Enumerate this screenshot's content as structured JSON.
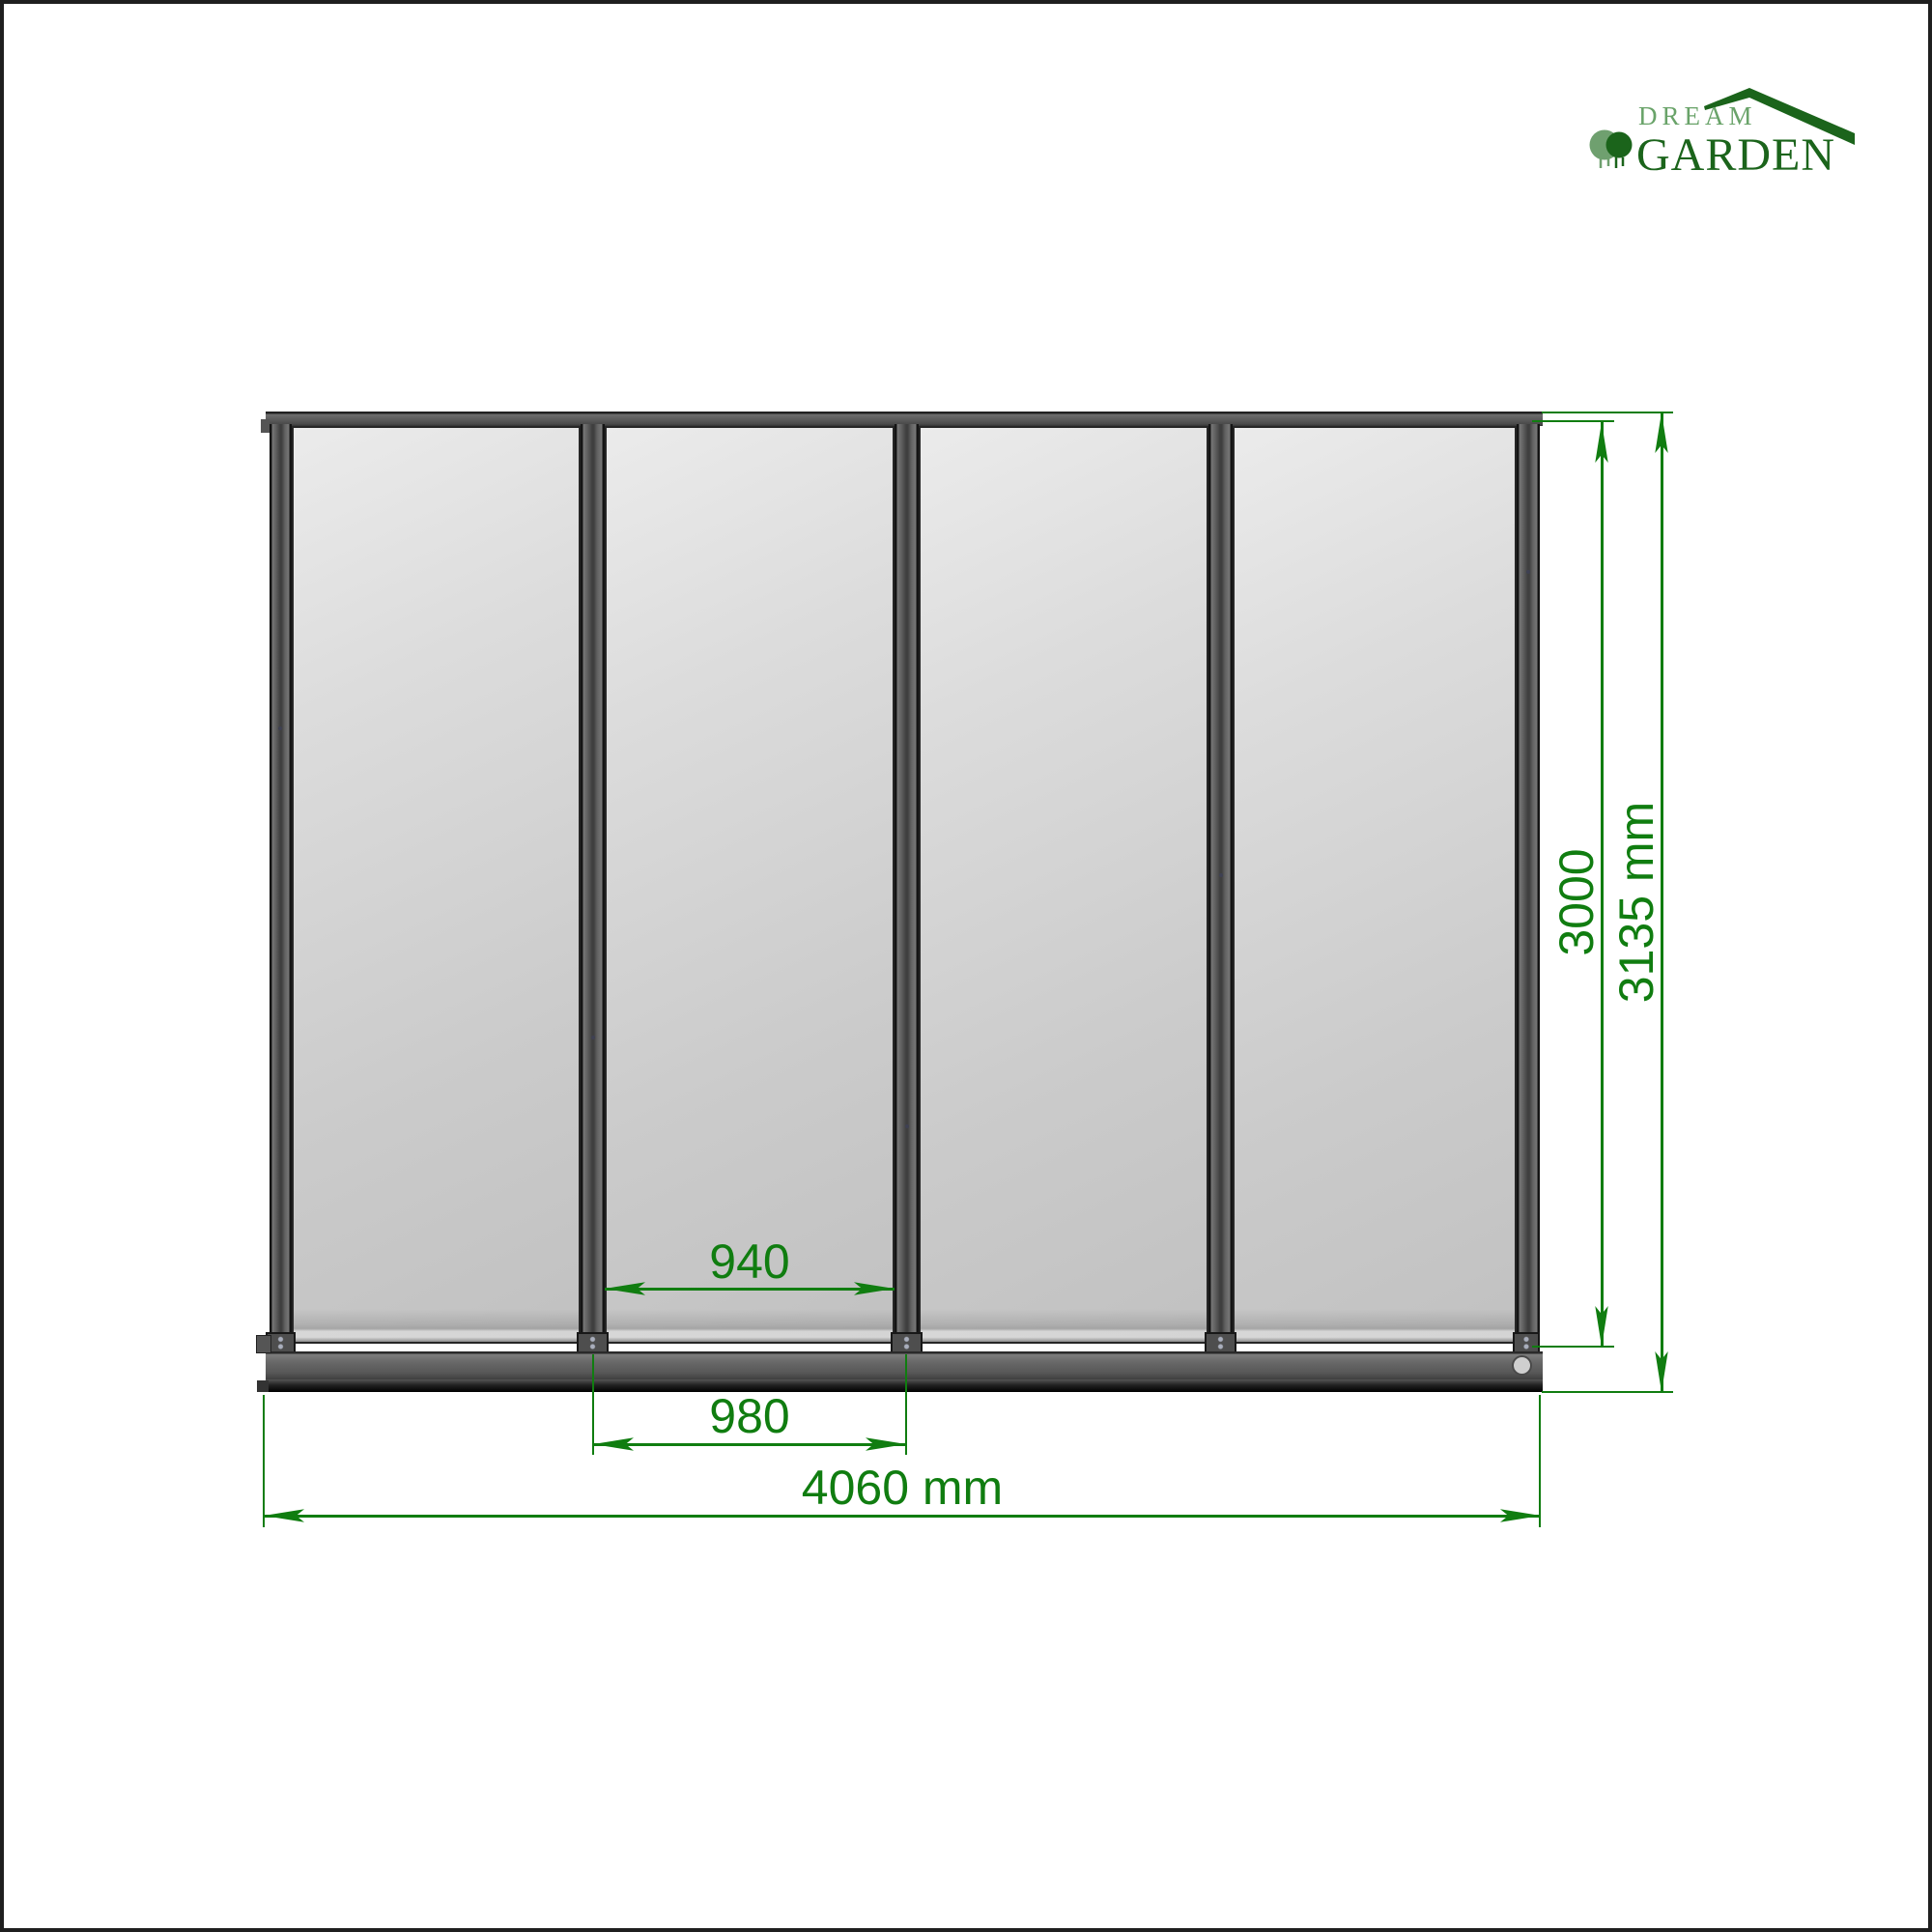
{
  "brand": {
    "word_top": "DREAM",
    "word_bottom": "GARDEN",
    "icons": [
      "tree-icon",
      "roof-icon"
    ],
    "color_light_green": "#69A369",
    "color_dark_green": "#1B641B"
  },
  "diagram": {
    "panel_count": 4,
    "labels": {
      "panel_glass_width": "940",
      "panel_pitch": "980",
      "overall_width": "4060 mm",
      "frame_height": "3000",
      "overall_height": "3135 mm"
    },
    "dimension_color": "#107D10",
    "frame_color": "#5E5E5E",
    "glass_color": "#CBCBCB",
    "background_color": "#FFFFFF"
  }
}
